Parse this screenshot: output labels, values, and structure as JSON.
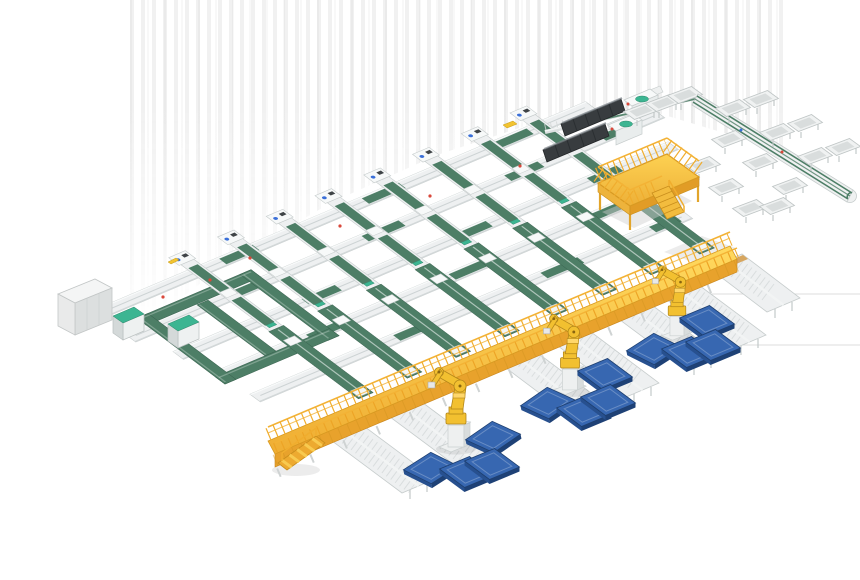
{
  "scene": {
    "colors": {
      "background": "#ffffff",
      "belt_green": "#4d7e66",
      "belt_green_dark": "#3a6350",
      "accent_teal": "#3cb592",
      "frame_white": "#eef0f1",
      "frame_outline": "#c6cccc",
      "walkway_yellow": "#f5bc40",
      "walkway_yellow_deep": "#e8a22c",
      "robot_yellow": "#f2c030",
      "pallet_blue": "#3767b1",
      "pallet_blue_dark": "#27508f",
      "machine_dark": "#383c3f",
      "cabinet_gray": "#e9ebeb",
      "marker_red": "#d9483b",
      "marker_blue": "#3a6fd8",
      "tan_wood": "#d7a65f",
      "floor_line": "#dedede",
      "shadow_soft": "#ececec"
    },
    "counts": {
      "branch_conveyor_lines": 8,
      "trunk_conveyor_lines": 5,
      "palletizing_robots": 3,
      "blue_pallets": 12,
      "spur_conveyors": 7,
      "tray_chutes": 16,
      "teal_cabinets": 2,
      "dark_loader_machines": 2,
      "mezzanine_platforms": 1,
      "elevated_walkways": 1,
      "control_cabinets": 1,
      "recirculation_loops": 1,
      "floor_lines": 2
    }
  }
}
